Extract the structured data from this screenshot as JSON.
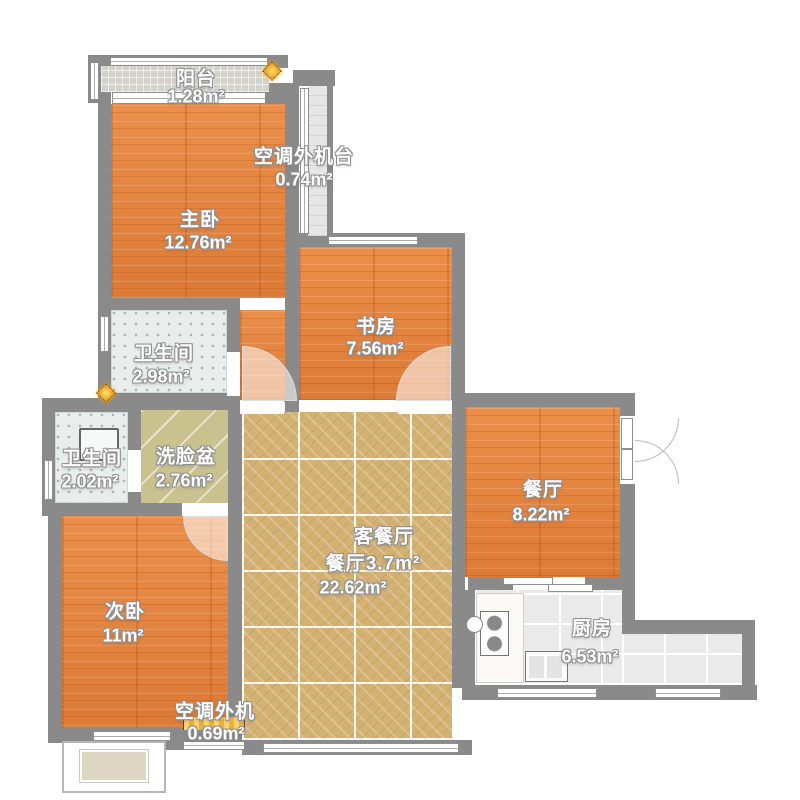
{
  "plan": {
    "type": "apartment-floor-plan",
    "unit_suffix": "m²",
    "rooms": [
      {
        "id": "balcony",
        "name": "阳台",
        "area": "1.28m²"
      },
      {
        "id": "ac-platform-top",
        "name": "空调外机台",
        "area": "0.74m²"
      },
      {
        "id": "master-bedroom",
        "name": "主卧",
        "area": "12.76m²"
      },
      {
        "id": "study",
        "name": "书房",
        "area": "7.56m²"
      },
      {
        "id": "bathroom-main",
        "name": "卫生间",
        "area": "2.98m²"
      },
      {
        "id": "bathroom-small",
        "name": "卫生间",
        "area": "2.02m²"
      },
      {
        "id": "washbasin",
        "name": "洗脸盆",
        "area": "2.76m²"
      },
      {
        "id": "living-dining",
        "name": "客餐厅",
        "area": "22.62m²"
      },
      {
        "id": "dining-nook",
        "name": "餐厅",
        "area": "3.7m²"
      },
      {
        "id": "dining",
        "name": "餐厅",
        "area": "8.22m²"
      },
      {
        "id": "second-bedroom",
        "name": "次卧",
        "area": "11m²"
      },
      {
        "id": "kitchen",
        "name": "厨房",
        "area": "6.53m²"
      },
      {
        "id": "ac-platform-bottom",
        "name": "空调外机",
        "area": "0.69m²"
      }
    ],
    "colors": {
      "wall": "#8a8a8a",
      "wood_floor": "#e28140",
      "living_tile": "#d3b173",
      "bath_tile": "#e9eeec",
      "basin_tile": "#cac28e",
      "kitchen_tile": "#eaeaea",
      "balcony_tile": "#d4d2cb",
      "ac_hatch": "#f2b33e"
    },
    "icons": [
      {
        "name": "light-icon",
        "shape": "diamond",
        "color": "#efa62f",
        "count": 2
      }
    ],
    "fixtures": [
      "toilet",
      "kitchen-counter",
      "cooktop",
      "sink",
      "water-heater",
      "bay-window",
      "sliding-door",
      "entry-double-door"
    ]
  }
}
